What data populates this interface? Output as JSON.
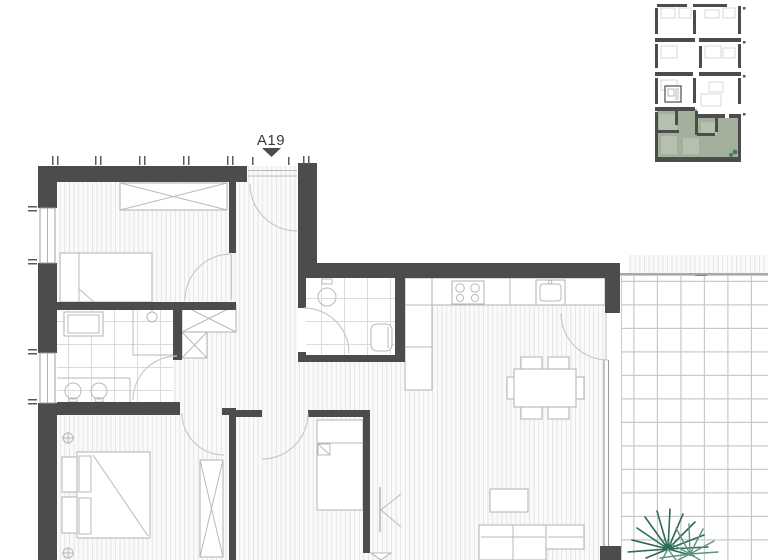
{
  "plan": {
    "unit_label": "A19",
    "marker_shape": "triangle-down"
  },
  "colors": {
    "wall": "#4c4c4c",
    "furniture_line": "#b9b9b9",
    "door_arc": "#c9c9c9",
    "floor_line": "#e3e3e3",
    "floor_bg": "#fafafa",
    "tile_line": "#dcdcdc",
    "balcony_line": "#c6cbc6",
    "window_line": "#9e9e9e",
    "tick": "#5a5a5a",
    "keyplan_highlight": "#a3b09c",
    "keyplan_room": "#b6c0af",
    "plant_dark": "#2e6b55",
    "plant_light": "#5d947e"
  }
}
